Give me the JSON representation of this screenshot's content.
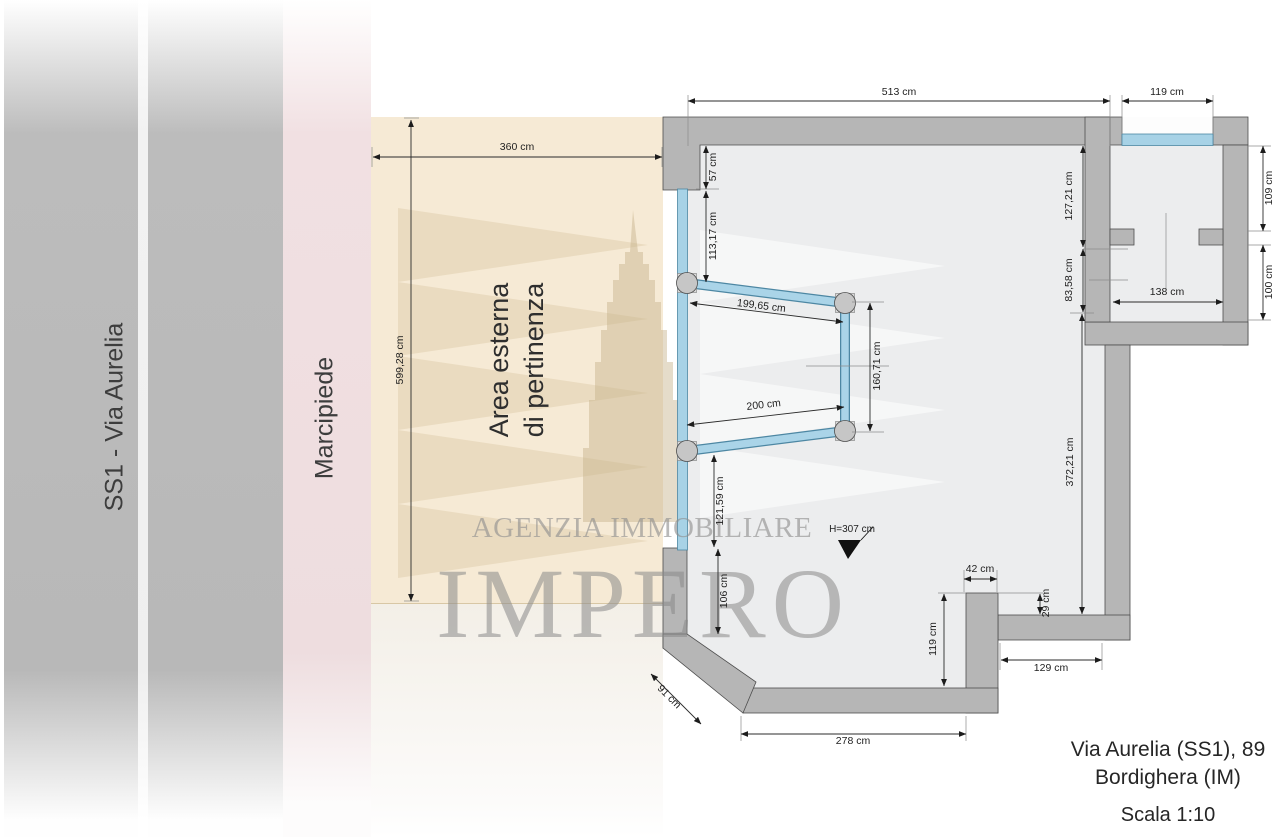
{
  "title_block": {
    "address_line1": "Via Aurelia (SS1), 89",
    "address_line2": "Bordighera (IM)",
    "scale_label": "Scala 1:10"
  },
  "zones": {
    "road_label": "SS1 - Via Aurelia",
    "sidewalk_label": "Marcipiede",
    "external_area_label_line1": "Area esterna",
    "external_area_label_line2": "di pertinenza"
  },
  "watermark": {
    "agency_line": "AGENZIA IMMOBILIARE",
    "brand_line": "IMPERO"
  },
  "dimensions": {
    "external_area_width": "360 cm",
    "external_area_height": "599,28 cm",
    "main_top_width": "513 cm",
    "window_top_width": "119 cm",
    "left_wall_top_segment": "57 cm",
    "left_glass_upper": "113,17 cm",
    "bay_back_upper": "199,65 cm",
    "bay_front_height": "160,71 cm",
    "bay_back_lower": "200 cm",
    "left_glass_lower": "121,59 cm",
    "left_wall_bottom_segment": "106 cm",
    "right_room_top_depth": "127,21 cm",
    "right_room_bottom_depth": "83,58 cm",
    "main_right_depth": "372,21 cm",
    "right_room_top_height": "109 cm",
    "right_room_bottom_height": "100 cm",
    "right_room_bottom_width": "138 cm",
    "pillar_width": "42 cm",
    "pillar_offset": "29 cm",
    "pillar_height": "119 cm",
    "bottom_right_recess_width": "129 cm",
    "bottom_wall_width": "278 cm",
    "diagonal_wall_length": "91 cm",
    "interior_height": "H=307 cm"
  },
  "colors": {
    "wall_gray": "#b6b6b6",
    "wall_outline": "#4d4d4d",
    "glass_blue": "#a7d2e6",
    "floor_gray": "#ecedee",
    "external_area_beige": "#f6ead5",
    "sidewalk_pink": "#eedddf",
    "road_gray": "#b8b8b8",
    "dimension_ink": "#1f1f1f",
    "watermark_gray": "#8f8f8f"
  }
}
